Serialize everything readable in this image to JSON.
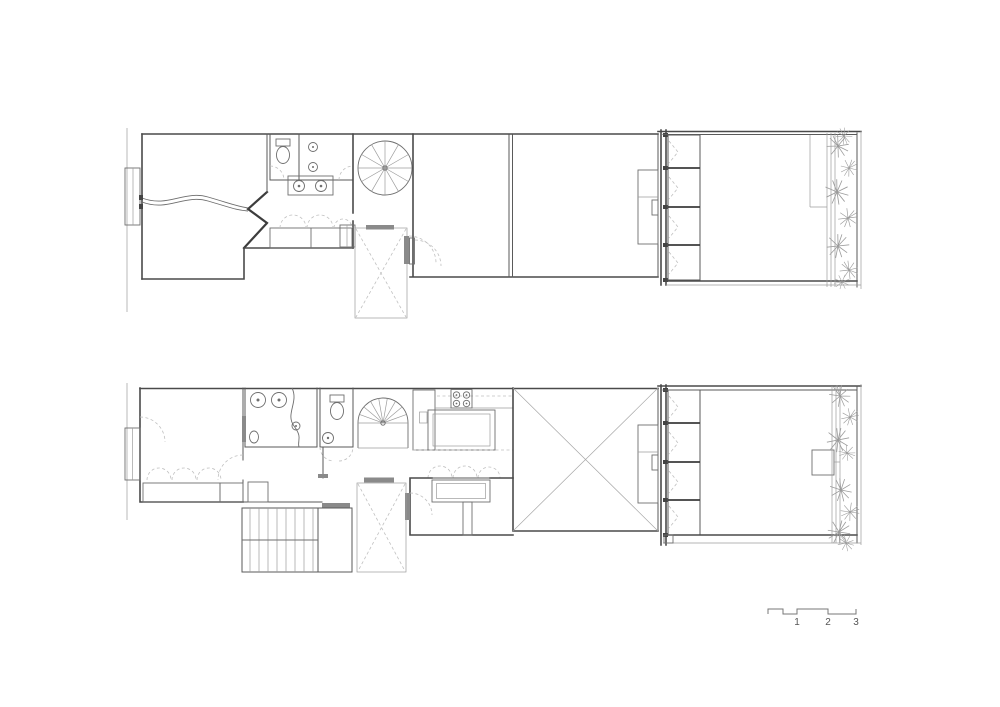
{
  "scale_bar": {
    "labels": [
      "1",
      "2",
      "3"
    ]
  },
  "colors": {
    "background": "#ffffff",
    "wall_line": "#4a4a4a",
    "furniture_line": "#6e6e6e",
    "light_line": "#9c9c9c",
    "dashed_line": "#c0c0c0",
    "plant_line": "#9b9b9b",
    "scale_text": "#555555"
  }
}
